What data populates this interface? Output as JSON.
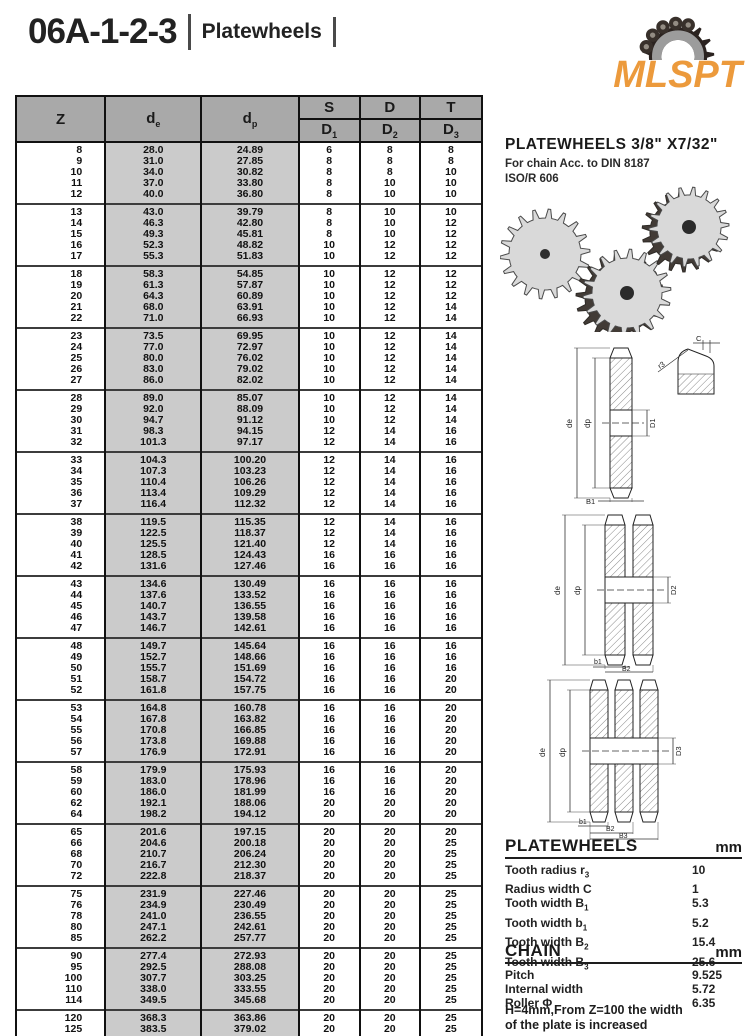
{
  "header": {
    "model": "06A-1-2-3",
    "category": "Platewheels",
    "logo_text": "MLSPT",
    "logo_color": "#EC9A3C"
  },
  "table": {
    "headers": {
      "z": "Z",
      "de_main": "d",
      "de_sub": "e",
      "dp_main": "d",
      "dp_sub": "p",
      "s": "S",
      "d": "D",
      "t": "T",
      "d1_main": "D",
      "d1_sub": "1",
      "d2_main": "D",
      "d2_sub": "2",
      "d3_main": "D",
      "d3_sub": "3"
    },
    "groups": [
      [
        [
          "8",
          "28.0",
          "24.89",
          "6",
          "8",
          "8"
        ],
        [
          "9",
          "31.0",
          "27.85",
          "8",
          "8",
          "8"
        ],
        [
          "10",
          "34.0",
          "30.82",
          "8",
          "8",
          "10"
        ],
        [
          "11",
          "37.0",
          "33.80",
          "8",
          "10",
          "10"
        ],
        [
          "12",
          "40.0",
          "36.80",
          "8",
          "10",
          "10"
        ]
      ],
      [
        [
          "13",
          "43.0",
          "39.79",
          "8",
          "10",
          "10"
        ],
        [
          "14",
          "46.3",
          "42.80",
          "8",
          "10",
          "12"
        ],
        [
          "15",
          "49.3",
          "45.81",
          "8",
          "10",
          "12"
        ],
        [
          "16",
          "52.3",
          "48.82",
          "10",
          "12",
          "12"
        ],
        [
          "17",
          "55.3",
          "51.83",
          "10",
          "12",
          "12"
        ]
      ],
      [
        [
          "18",
          "58.3",
          "54.85",
          "10",
          "12",
          "12"
        ],
        [
          "19",
          "61.3",
          "57.87",
          "10",
          "12",
          "12"
        ],
        [
          "20",
          "64.3",
          "60.89",
          "10",
          "12",
          "12"
        ],
        [
          "21",
          "68.0",
          "63.91",
          "10",
          "12",
          "14"
        ],
        [
          "22",
          "71.0",
          "66.93",
          "10",
          "12",
          "14"
        ]
      ],
      [
        [
          "23",
          "73.5",
          "69.95",
          "10",
          "12",
          "14"
        ],
        [
          "24",
          "77.0",
          "72.97",
          "10",
          "12",
          "14"
        ],
        [
          "25",
          "80.0",
          "76.02",
          "10",
          "12",
          "14"
        ],
        [
          "26",
          "83.0",
          "79.02",
          "10",
          "12",
          "14"
        ],
        [
          "27",
          "86.0",
          "82.02",
          "10",
          "12",
          "14"
        ]
      ],
      [
        [
          "28",
          "89.0",
          "85.07",
          "10",
          "12",
          "14"
        ],
        [
          "29",
          "92.0",
          "88.09",
          "10",
          "12",
          "14"
        ],
        [
          "30",
          "94.7",
          "91.12",
          "10",
          "12",
          "14"
        ],
        [
          "31",
          "98.3",
          "94.15",
          "12",
          "14",
          "16"
        ],
        [
          "32",
          "101.3",
          "97.17",
          "12",
          "14",
          "16"
        ]
      ],
      [
        [
          "33",
          "104.3",
          "100.20",
          "12",
          "14",
          "16"
        ],
        [
          "34",
          "107.3",
          "103.23",
          "12",
          "14",
          "16"
        ],
        [
          "35",
          "110.4",
          "106.26",
          "12",
          "14",
          "16"
        ],
        [
          "36",
          "113.4",
          "109.29",
          "12",
          "14",
          "16"
        ],
        [
          "37",
          "116.4",
          "112.32",
          "12",
          "14",
          "16"
        ]
      ],
      [
        [
          "38",
          "119.5",
          "115.35",
          "12",
          "14",
          "16"
        ],
        [
          "39",
          "122.5",
          "118.37",
          "12",
          "14",
          "16"
        ],
        [
          "40",
          "125.5",
          "121.40",
          "12",
          "14",
          "16"
        ],
        [
          "41",
          "128.5",
          "124.43",
          "16",
          "16",
          "16"
        ],
        [
          "42",
          "131.6",
          "127.46",
          "16",
          "16",
          "16"
        ]
      ],
      [
        [
          "43",
          "134.6",
          "130.49",
          "16",
          "16",
          "16"
        ],
        [
          "44",
          "137.6",
          "133.52",
          "16",
          "16",
          "16"
        ],
        [
          "45",
          "140.7",
          "136.55",
          "16",
          "16",
          "16"
        ],
        [
          "46",
          "143.7",
          "139.58",
          "16",
          "16",
          "16"
        ],
        [
          "47",
          "146.7",
          "142.61",
          "16",
          "16",
          "16"
        ]
      ],
      [
        [
          "48",
          "149.7",
          "145.64",
          "16",
          "16",
          "16"
        ],
        [
          "49",
          "152.7",
          "148.66",
          "16",
          "16",
          "16"
        ],
        [
          "50",
          "155.7",
          "151.69",
          "16",
          "16",
          "16"
        ],
        [
          "51",
          "158.7",
          "154.72",
          "16",
          "16",
          "20"
        ],
        [
          "52",
          "161.8",
          "157.75",
          "16",
          "16",
          "20"
        ]
      ],
      [
        [
          "53",
          "164.8",
          "160.78",
          "16",
          "16",
          "20"
        ],
        [
          "54",
          "167.8",
          "163.82",
          "16",
          "16",
          "20"
        ],
        [
          "55",
          "170.8",
          "166.85",
          "16",
          "16",
          "20"
        ],
        [
          "56",
          "173.8",
          "169.88",
          "16",
          "16",
          "20"
        ],
        [
          "57",
          "176.9",
          "172.91",
          "16",
          "16",
          "20"
        ]
      ],
      [
        [
          "58",
          "179.9",
          "175.93",
          "16",
          "16",
          "20"
        ],
        [
          "59",
          "183.0",
          "178.96",
          "16",
          "16",
          "20"
        ],
        [
          "60",
          "186.0",
          "181.99",
          "16",
          "16",
          "20"
        ],
        [
          "62",
          "192.1",
          "188.06",
          "20",
          "20",
          "20"
        ],
        [
          "64",
          "198.2",
          "194.12",
          "20",
          "20",
          "20"
        ]
      ],
      [
        [
          "65",
          "201.6",
          "197.15",
          "20",
          "20",
          "20"
        ],
        [
          "66",
          "204.6",
          "200.18",
          "20",
          "20",
          "25"
        ],
        [
          "68",
          "210.7",
          "206.24",
          "20",
          "20",
          "25"
        ],
        [
          "70",
          "216.7",
          "212.30",
          "20",
          "20",
          "25"
        ],
        [
          "72",
          "222.8",
          "218.37",
          "20",
          "20",
          "25"
        ]
      ],
      [
        [
          "75",
          "231.9",
          "227.46",
          "20",
          "20",
          "25"
        ],
        [
          "76",
          "234.9",
          "230.49",
          "20",
          "20",
          "25"
        ],
        [
          "78",
          "241.0",
          "236.55",
          "20",
          "20",
          "25"
        ],
        [
          "80",
          "247.1",
          "242.61",
          "20",
          "20",
          "25"
        ],
        [
          "85",
          "262.2",
          "257.77",
          "20",
          "20",
          "25"
        ]
      ],
      [
        [
          "90",
          "277.4",
          "272.93",
          "20",
          "20",
          "25"
        ],
        [
          "95",
          "292.5",
          "288.08",
          "20",
          "20",
          "25"
        ],
        [
          "100",
          "307.7",
          "303.25",
          "20",
          "20",
          "25"
        ],
        [
          "110",
          "338.0",
          "333.55",
          "20",
          "20",
          "25"
        ],
        [
          "114",
          "349.5",
          "345.68",
          "20",
          "20",
          "25"
        ]
      ],
      [
        [
          "120",
          "368.3",
          "363.86",
          "20",
          "20",
          "25"
        ],
        [
          "125",
          "383.5",
          "379.02",
          "20",
          "20",
          "25"
        ]
      ]
    ]
  },
  "right": {
    "title": "PLATEWHEELS  3/8\" X7/32\"",
    "subtitle1": "For chain Acc. to DIN 8187",
    "subtitle2": "ISO/R 606",
    "note_line1": "H=4mm,From Z=100 the width",
    "note_line2": "of the plate is increased"
  },
  "specs": [
    {
      "title": "PLATEWHEELS",
      "unit": "mm",
      "rows": [
        {
          "label": "Tooth radius r",
          "sub": "3",
          "value": "10"
        },
        {
          "label": "Radius width C",
          "sub": "",
          "value": "1"
        },
        {
          "label": "Tooth width B",
          "sub": "1",
          "value": "5.3"
        },
        {
          "label": "Tooth width b",
          "sub": "1",
          "value": "5.2"
        },
        {
          "label": "Tooth width B",
          "sub": "2",
          "value": "15.4"
        },
        {
          "label": "Tooth width B",
          "sub": "3",
          "value": "25.6"
        }
      ]
    },
    {
      "title": "CHAIN",
      "unit": "mm",
      "rows": [
        {
          "label": "Pitch",
          "sub": "",
          "value": "9.525"
        },
        {
          "label": "Internal width",
          "sub": "",
          "value": "5.72"
        },
        {
          "label": "Roller Φ",
          "sub": "",
          "value": "6.35"
        }
      ]
    }
  ],
  "diagrams": {
    "single": {
      "de": "de",
      "dp": "dp",
      "bore": "D1",
      "b": "B1",
      "c": "C",
      "r": "r3"
    },
    "double": {
      "de": "de",
      "dp": "dp",
      "bore": "D2",
      "b1": "b1",
      "b2": "B2"
    },
    "triple": {
      "de": "de",
      "dp": "dp",
      "bore": "D3",
      "b1": "b1",
      "b2": "B2",
      "b3": "B3"
    }
  }
}
